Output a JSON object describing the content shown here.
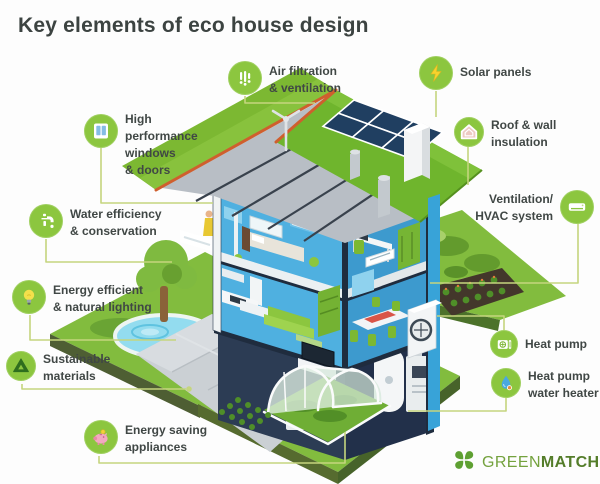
{
  "title": "Key elements of eco house design",
  "callouts": [
    {
      "label": "Air filtration\n& ventilation",
      "icon": "fan-icon"
    },
    {
      "label": "Solar panels",
      "icon": "lightning-icon"
    },
    {
      "label": "High\nperformance\nwindows\n& doors",
      "icon": "window-icon"
    },
    {
      "label": "Roof & wall\ninsulation",
      "icon": "insulated-house-icon"
    },
    {
      "label": "Water efficiency\n& conservation",
      "icon": "faucet-icon"
    },
    {
      "label": "Ventilation/\nHVAC system",
      "icon": "ac-unit-icon"
    },
    {
      "label": "Energy efficient\n& natural lighting",
      "icon": "lightbulb-icon"
    },
    {
      "label": "Sustainable\nmaterials",
      "icon": "recycle-icon"
    },
    {
      "label": "Heat pump",
      "icon": "heat-pump-icon"
    },
    {
      "label": "Heat pump\nwater heater",
      "icon": "water-drop-icon"
    },
    {
      "label": "Energy saving\nappliances",
      "icon": "piggy-bank-icon"
    }
  ],
  "brand": {
    "green": "GREEN",
    "match": "MATCH",
    "icon": "clover-icon"
  },
  "colors": {
    "accent_green": "#8cc63f",
    "connector_green": "#c5d57e",
    "text_dark": "#404745",
    "roof_green": "#7cb832",
    "roof_edge_orange": "#cf5f2e",
    "interior_blue": "#4fb0e0",
    "solar_panel_navy": "#203f61",
    "lawn_green": "#82bc3e",
    "pool_blue": "#93dcef",
    "brand_green": "#74a23e"
  }
}
